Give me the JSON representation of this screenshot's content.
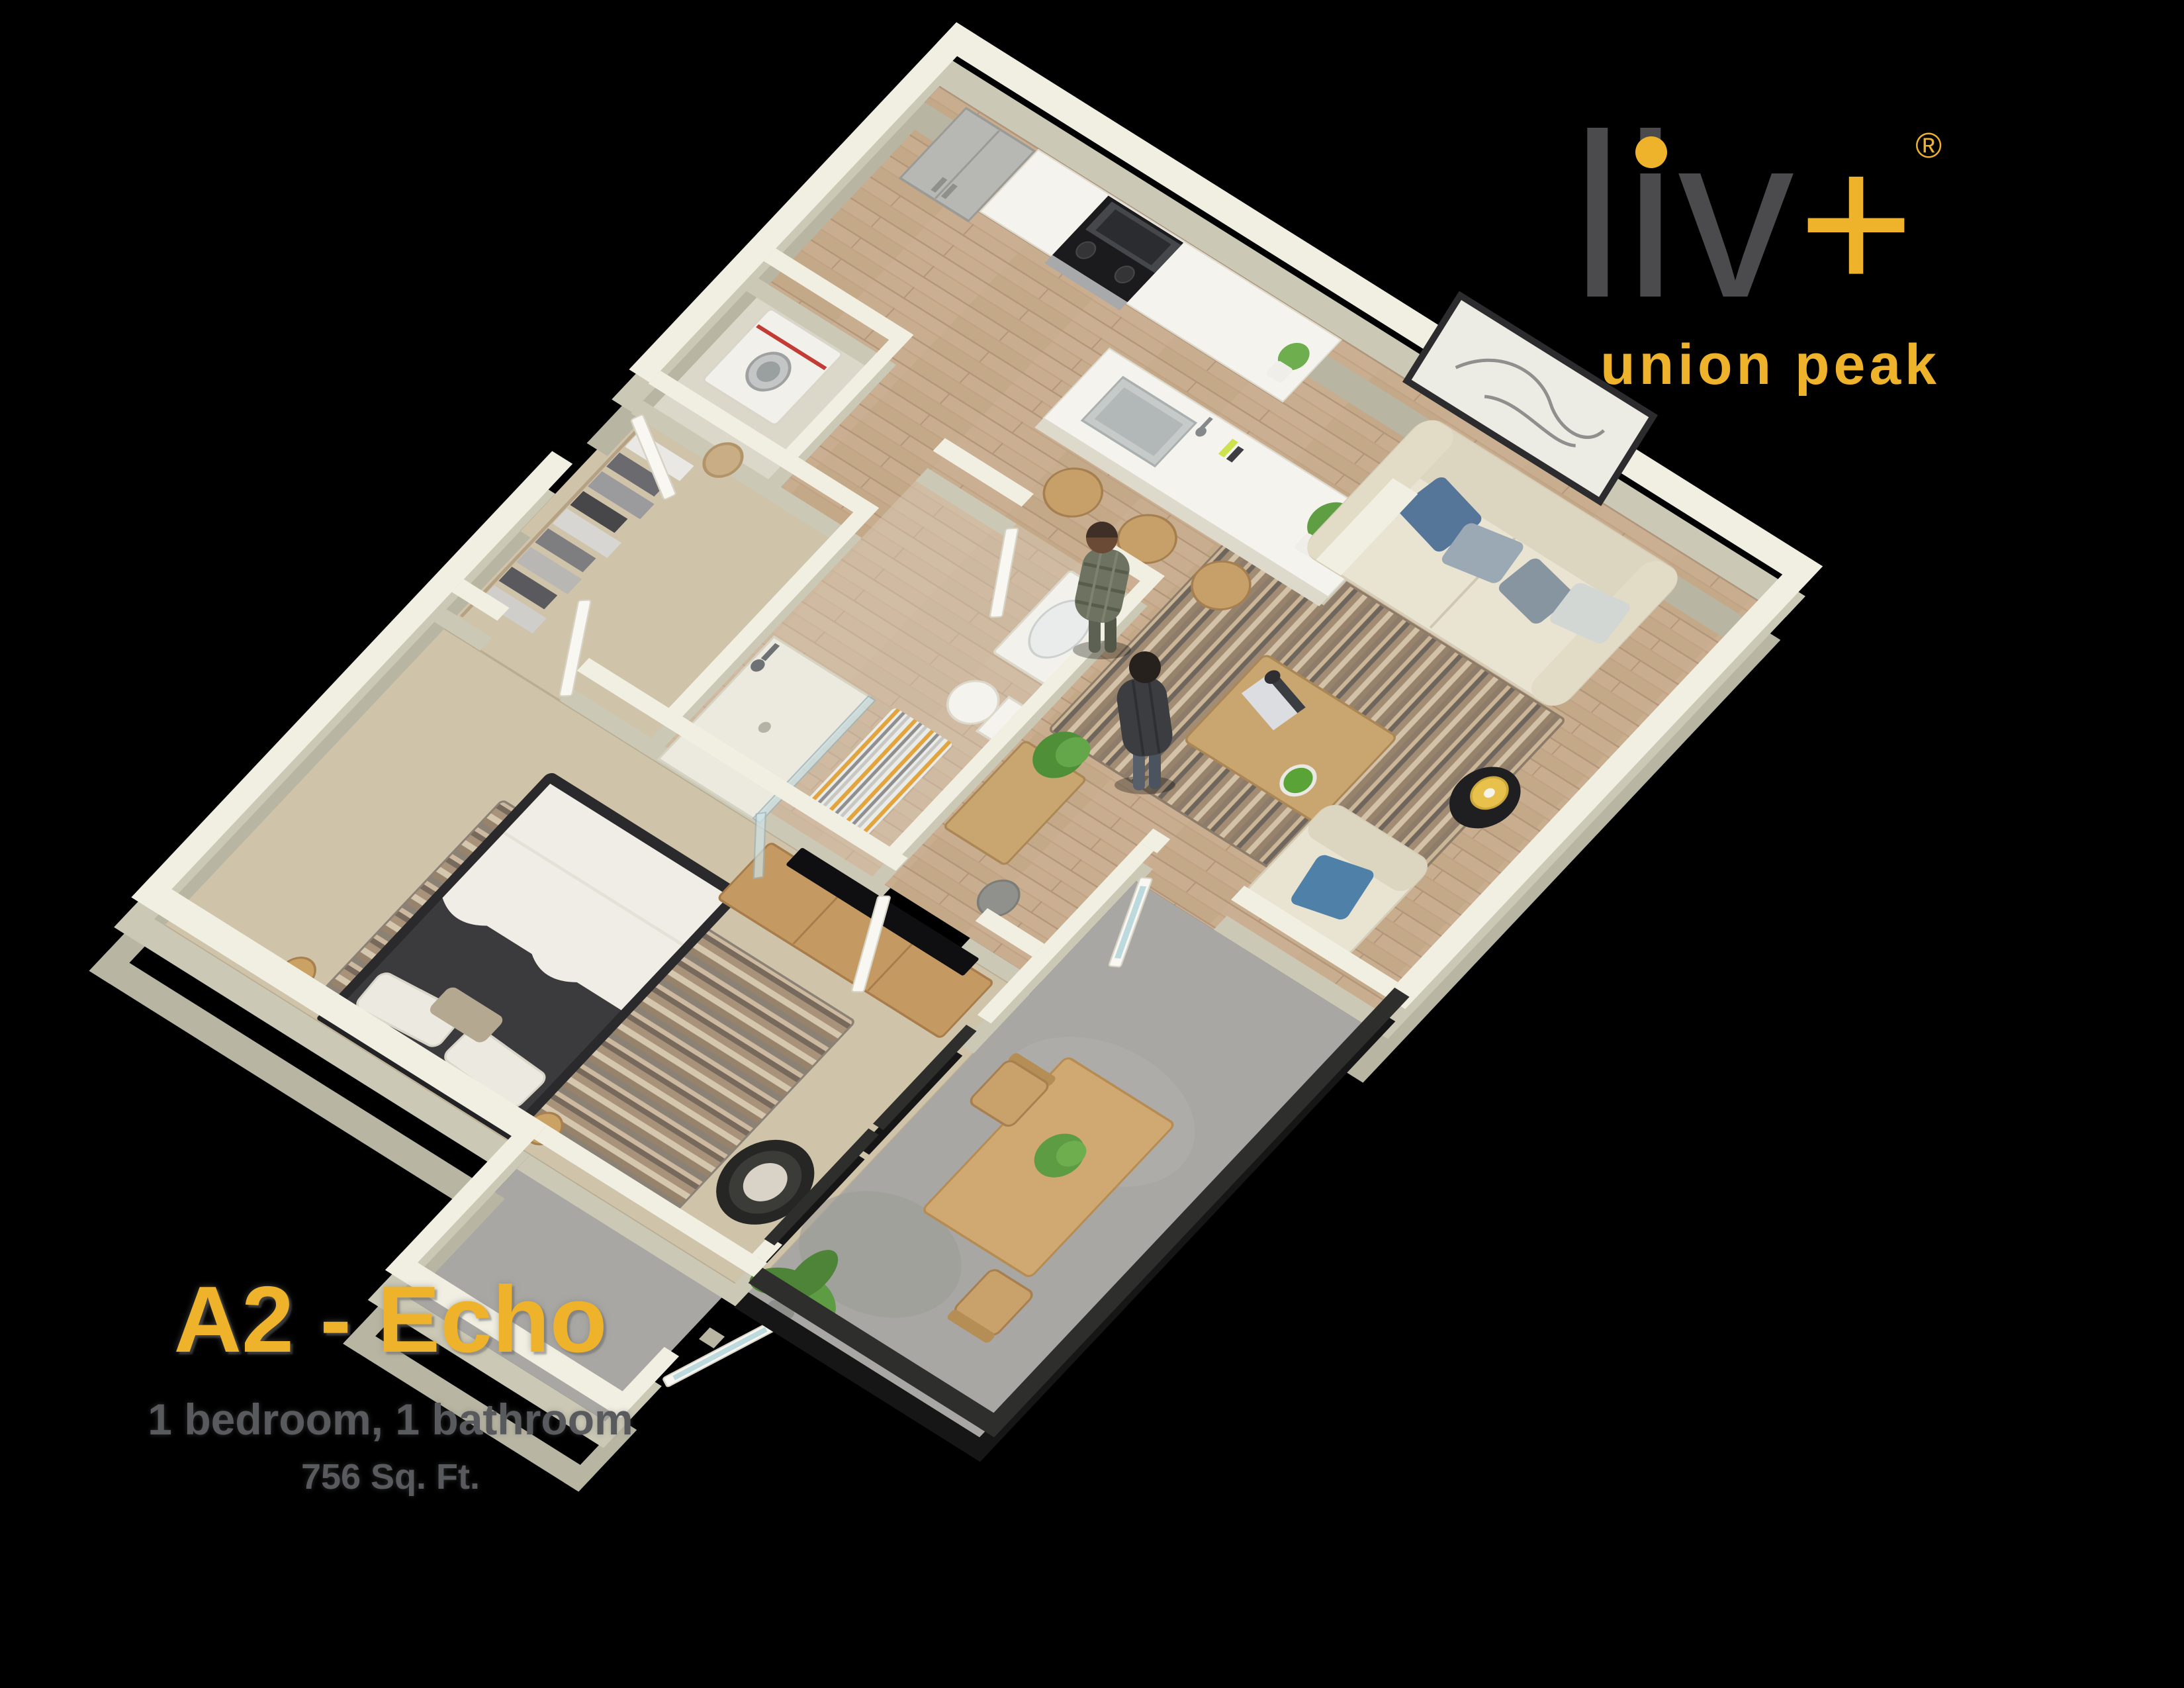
{
  "page": {
    "background_color": "#000000"
  },
  "logo": {
    "brand": "liv",
    "plus": "+",
    "registered_mark": "®",
    "tagline": "union peak",
    "brand_color": "#4b4b4d",
    "accent_color": "#efb32b"
  },
  "plan_info": {
    "name": "A2 - Echo",
    "details": "1 bedroom, 1 bathroom",
    "area": "756 Sq. Ft.",
    "name_color": "#efb32b",
    "details_color": "#595a5e"
  },
  "floorplan": {
    "type": "3d-isometric-apartment-render",
    "rooms": [
      "kitchen",
      "living-room",
      "bedroom",
      "bathroom",
      "walk-in-closet",
      "laundry-closet",
      "entry",
      "hallway",
      "balcony",
      "storage-alcove"
    ],
    "colors": {
      "walls": "#f1efe2",
      "wood_floor": "#c8ad8e",
      "carpet": "#cfc3aa",
      "balcony_concrete": "#a8a7a3",
      "railing": "#161616"
    }
  }
}
